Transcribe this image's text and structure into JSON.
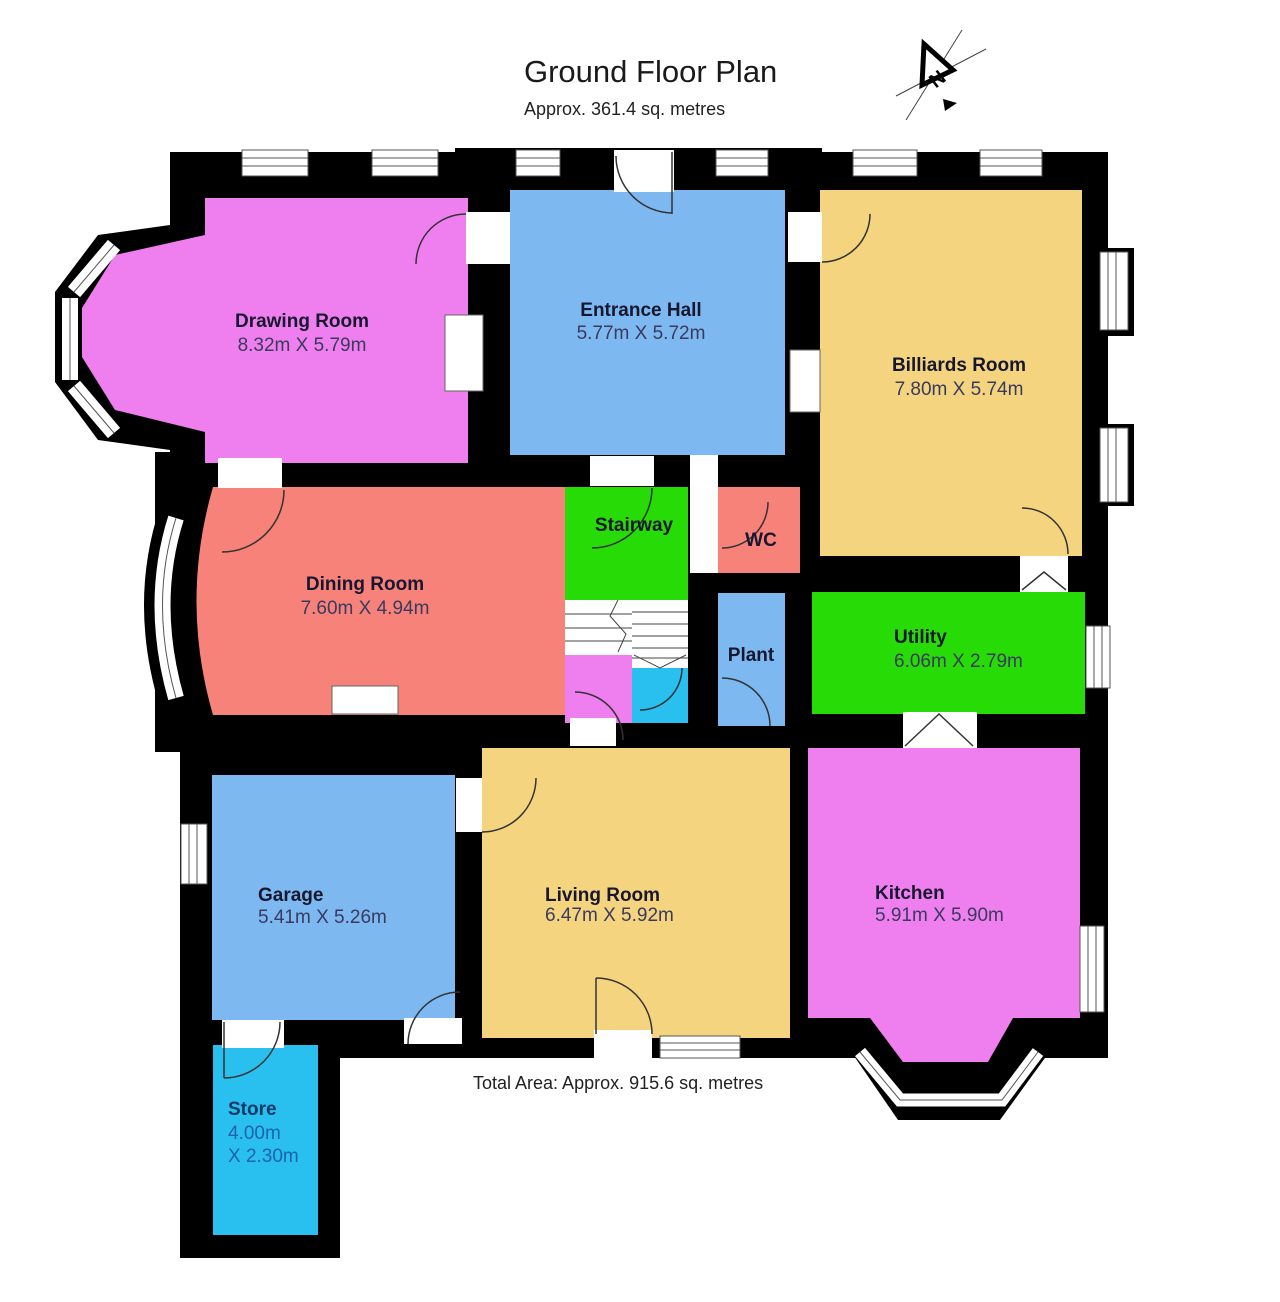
{
  "title": {
    "main": "Ground Floor Plan",
    "subtitle": "Approx. 361.4 sq. metres"
  },
  "footer": {
    "total_area": "Total Area: Approx. 915.6 sq. metres"
  },
  "north": {
    "label": "N"
  },
  "colors": {
    "wall": "#000000",
    "pink": "#EF7FEF",
    "blue": "#7DB9F0",
    "tan": "#F4D47F",
    "salmon": "#F7827A",
    "green": "#27DB06",
    "cyan": "#29BFEF"
  },
  "rooms": {
    "drawing": {
      "name": "Drawing Room",
      "dims": "8.32m X 5.79m",
      "color": "#EF7FEF"
    },
    "entrance": {
      "name": "Entrance Hall",
      "dims": "5.77m X 5.72m",
      "color": "#7DB9F0"
    },
    "billiards": {
      "name": "Billiards Room",
      "dims": "7.80m X 5.74m",
      "color": "#F4D47F"
    },
    "dining": {
      "name": "Dining Room",
      "dims": "7.60m X 4.94m",
      "color": "#F7827A"
    },
    "stairway": {
      "name": "Stairway",
      "color": "#27DB06"
    },
    "wc": {
      "name": "WC",
      "color": "#F7827A"
    },
    "plant": {
      "name": "Plant",
      "color": "#7DB9F0"
    },
    "utility": {
      "name": "Utility",
      "dims": "6.06m X 2.79m",
      "color": "#27DB06"
    },
    "garage": {
      "name": "Garage",
      "dims": "5.41m X 5.26m",
      "color": "#7DB9F0"
    },
    "living": {
      "name": "Living Room",
      "dims": "6.47m X 5.92m",
      "color": "#F4D47F"
    },
    "kitchen": {
      "name": "Kitchen",
      "dims": "5.91m X 5.90m",
      "color": "#EF7FEF"
    },
    "store": {
      "name": "Store",
      "dims_line1": "4.00m",
      "dims_line2": "X 2.30m",
      "color": "#29BFEF"
    }
  }
}
